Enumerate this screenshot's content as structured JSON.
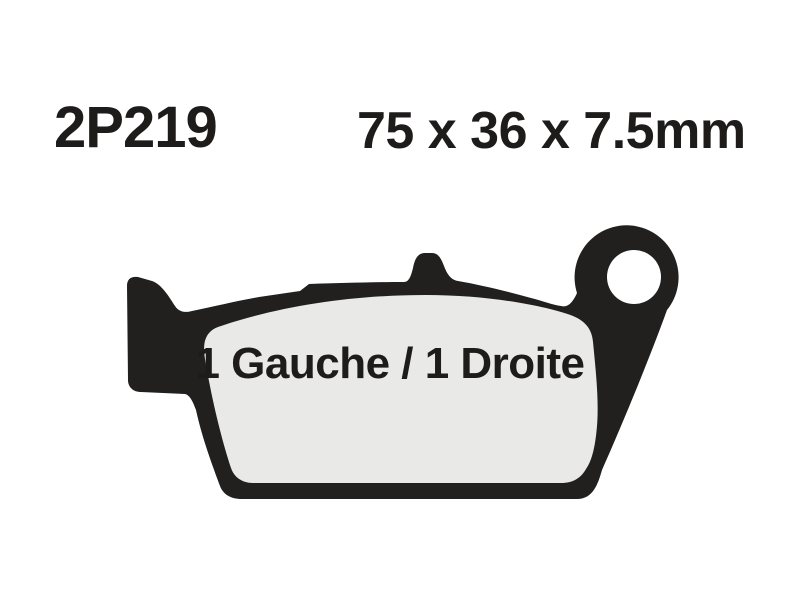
{
  "header": {
    "part_number": "2P219",
    "dimensions": "75 x 36 x 7.5mm"
  },
  "diagram": {
    "label": "1 Gauche / 1 Droite",
    "shape_name": "rear-brake-pad-outline",
    "features": [
      "backing-plate",
      "friction-pad",
      "mounting-lug",
      "mounting-hole",
      "locating-tab"
    ]
  },
  "colors": {
    "ink": "#1e1b1b",
    "plate": "#221f1f",
    "friction_pad": "#e9e9e8",
    "background": "#ffffff"
  }
}
